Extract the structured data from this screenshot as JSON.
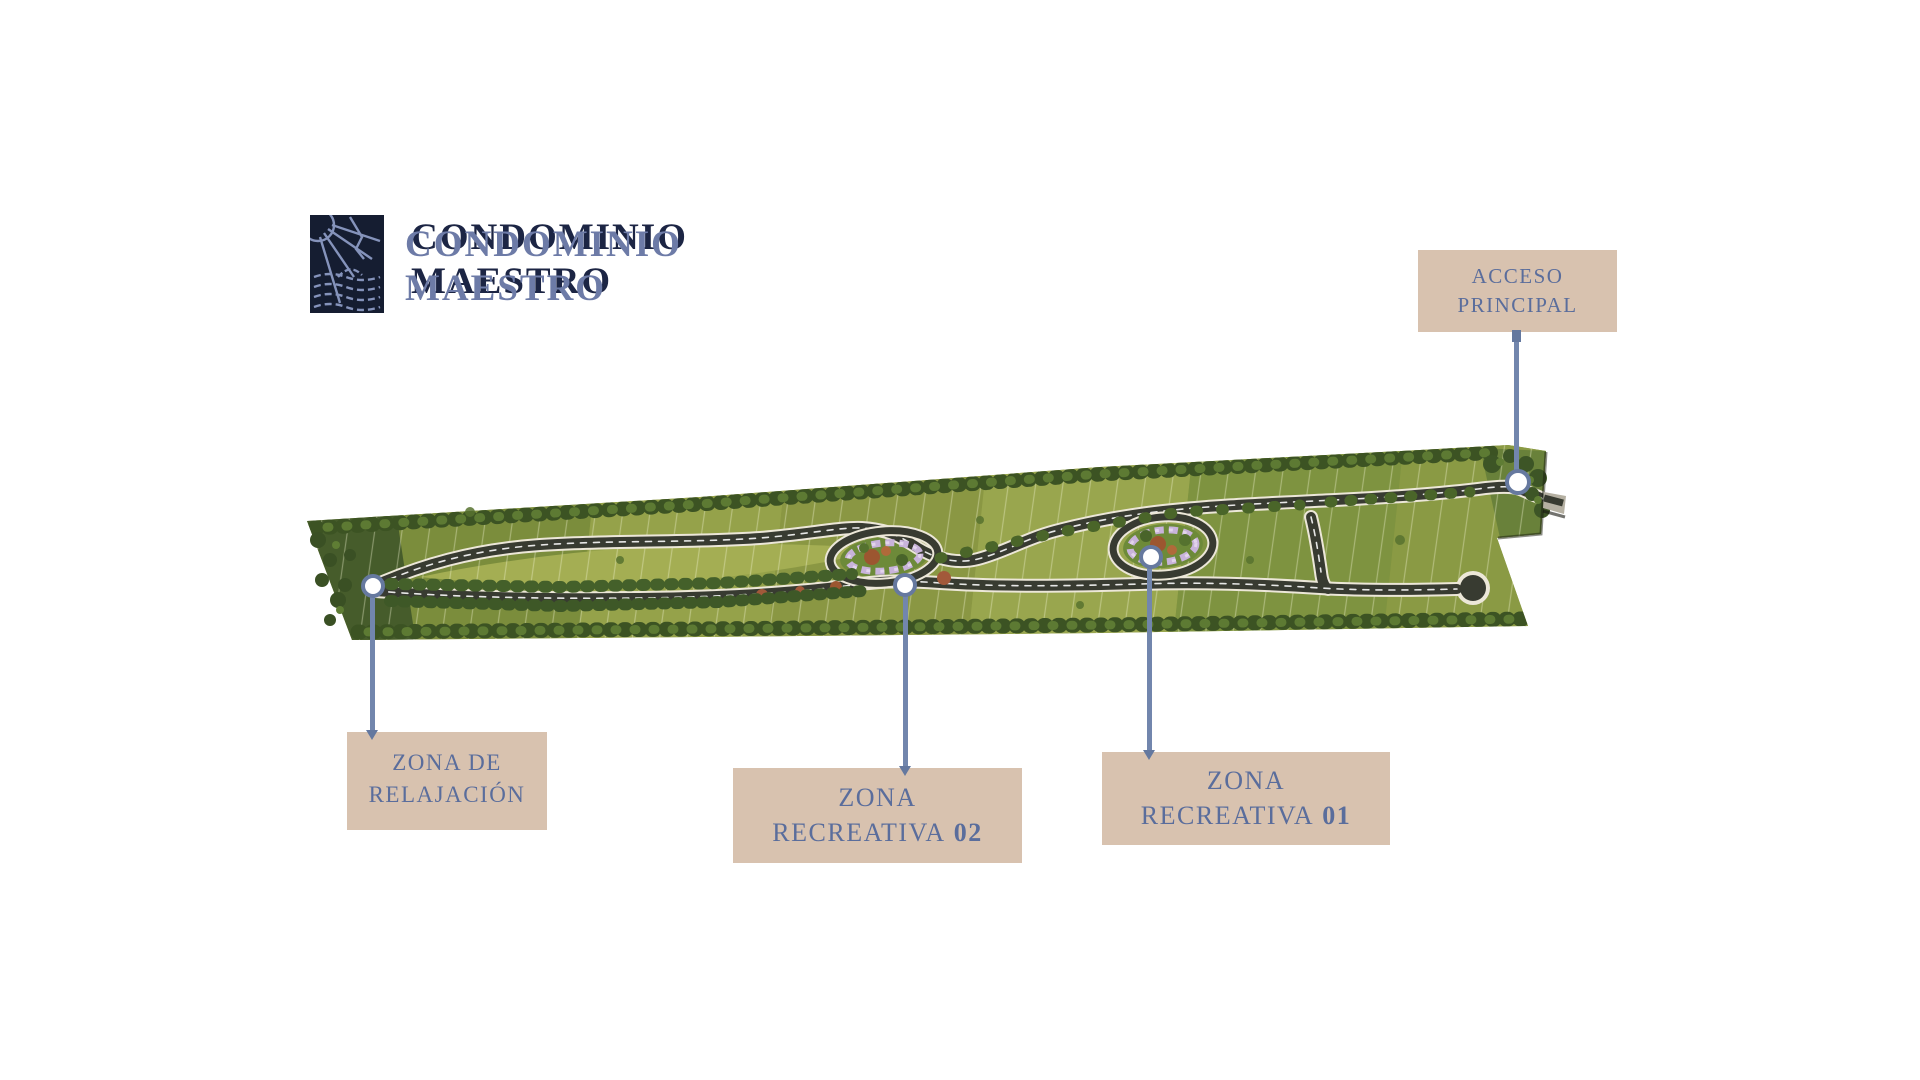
{
  "brand": {
    "logo_icon": "sailboat-sun-waves-icon",
    "name_line1": "CONDOMINIO",
    "name_line2": "MAESTRO"
  },
  "callouts": {
    "acceso_principal": {
      "line1": "ACCESO",
      "line2": "PRINCIPAL"
    },
    "zona_relajacion": {
      "line1": "ZONA DE",
      "line2": "RELAJACIÓN"
    },
    "zona_recreativa_02": {
      "line1": "ZONA",
      "line2_text": "RECREATIVA",
      "line2_number": "02"
    },
    "zona_recreativa_01": {
      "line1": "ZONA",
      "line2_text": "RECREATIVA",
      "line2_number": "01"
    }
  },
  "colors": {
    "background": "#ffffff",
    "label_box": "#d8c2af",
    "label_text": "#5a6d9c",
    "connector": "#7286ad",
    "marker_ring": "#66799f",
    "wordmark_front": "#6d7ba7",
    "wordmark_shadow": "#1c2544",
    "logo_background": "#151d31",
    "logo_lines": "#8593bb",
    "field_green": "#8a9743",
    "road_asphalt": "#383b31",
    "tree_green": "#3c5323",
    "flower_lavender": "#c8b3da",
    "tree_rust": "#9c5630"
  }
}
